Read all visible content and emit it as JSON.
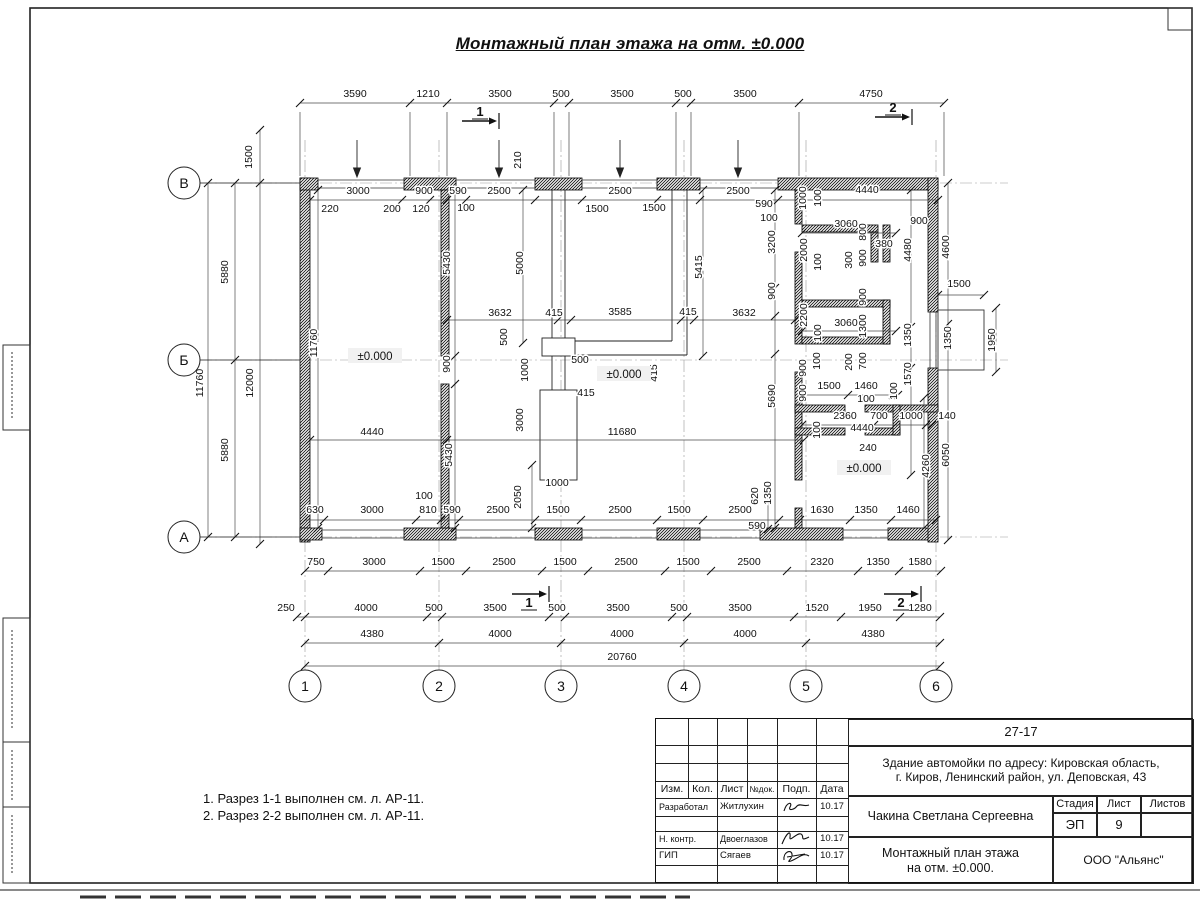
{
  "sheet": {
    "title": "Монтажный план этажа на отм. ±0.000",
    "notes": [
      "1. Разрез 1-1 выполнен см. л. АР-11.",
      "2. Разрез 2-2 выполнен см. л. АР-11."
    ]
  },
  "axes": {
    "row_labels": [
      "В",
      "Б",
      "А"
    ],
    "row_y": [
      183,
      360,
      537
    ],
    "col_labels": [
      "1",
      "2",
      "3",
      "4",
      "5",
      "6"
    ],
    "col_x": [
      305,
      439,
      561,
      684,
      806,
      936
    ]
  },
  "title_block": {
    "project_code": "27-17",
    "object_line1": "Здание автомойки по адресу: Кировская область,",
    "object_line2": "г. Киров, Ленинский район, ул. Деповская, 43",
    "client": "Чакина Светлана Сергеевна",
    "doc_title_line1": "Монтажный план этажа",
    "doc_title_line2": "на отм. ±0.000.",
    "organization": "ООО \"Альянс\"",
    "stage_label": "Стадия",
    "sheet_label": "Лист",
    "sheets_label": "Листов",
    "stage": "ЭП",
    "sheet_number": "9",
    "columns": [
      "Изм.",
      "Кол.",
      "Лист",
      "№док.",
      "Подп.",
      "Дата"
    ],
    "rows": [
      {
        "role": "Разработал",
        "name": "Житлухин",
        "date": "10.17"
      },
      {
        "role": "Н. контр.",
        "name": "Двоеглазов",
        "date": "10.17"
      },
      {
        "role": "ГИП",
        "name": "Сягаев",
        "date": "10.17"
      }
    ]
  },
  "drawing": {
    "dim_labels": [
      [
        "3590",
        355,
        97
      ],
      [
        "1210",
        428,
        97
      ],
      [
        "3500",
        500,
        97
      ],
      [
        "500",
        561,
        97
      ],
      [
        "3500",
        622,
        97
      ],
      [
        "500",
        683,
        97
      ],
      [
        "3500",
        745,
        97
      ],
      [
        "4750",
        871,
        97
      ],
      [
        "1500",
        252,
        157,
        1
      ],
      [
        "210",
        521,
        160,
        1
      ],
      [
        "3000",
        358,
        194
      ],
      [
        "900",
        424,
        194
      ],
      [
        "590",
        458,
        194
      ],
      [
        "2500",
        499,
        194
      ],
      [
        "2500",
        620,
        194
      ],
      [
        "2500",
        738,
        194
      ],
      [
        "4440",
        867,
        193
      ],
      [
        "220",
        330,
        212
      ],
      [
        "200",
        392,
        212
      ],
      [
        "120",
        421,
        212
      ],
      [
        "100",
        466,
        211
      ],
      [
        "1500",
        597,
        212
      ],
      [
        "1500",
        654,
        211
      ],
      [
        "590",
        764,
        207
      ],
      [
        "100",
        769,
        221
      ],
      [
        "1000",
        806,
        198,
        1
      ],
      [
        "100",
        821,
        198,
        1
      ],
      [
        "3060",
        846,
        227
      ],
      [
        "800",
        866,
        232,
        1
      ],
      [
        "900",
        919,
        224
      ],
      [
        "380",
        884,
        247
      ],
      [
        "2000",
        807,
        250,
        1
      ],
      [
        "100",
        821,
        262,
        1
      ],
      [
        "300",
        852,
        260,
        1
      ],
      [
        "900",
        866,
        258,
        1
      ],
      [
        "4480",
        911,
        250,
        1
      ],
      [
        "4600",
        949,
        247,
        1
      ],
      [
        "3200",
        775,
        242,
        1
      ],
      [
        "900",
        775,
        291,
        1
      ],
      [
        "5690",
        775,
        396,
        1
      ],
      [
        "5000",
        523,
        263,
        1
      ],
      [
        "5430",
        450,
        263,
        1
      ],
      [
        "5415",
        702,
        267,
        1
      ],
      [
        "11760",
        317,
        343,
        1
      ],
      [
        "5880",
        228,
        272,
        1
      ],
      [
        "11760",
        203,
        383,
        1
      ],
      [
        "12000",
        253,
        383,
        1
      ],
      [
        "5880",
        228,
        450,
        1
      ],
      [
        "3632",
        500,
        316
      ],
      [
        "415",
        554,
        316
      ],
      [
        "3585",
        620,
        315
      ],
      [
        "415",
        688,
        315
      ],
      [
        "3632",
        744,
        316
      ],
      [
        "500",
        507,
        337,
        1
      ],
      [
        "500",
        580,
        363
      ],
      [
        "900",
        450,
        364,
        1
      ],
      [
        "1000",
        528,
        370,
        1
      ],
      [
        "415",
        657,
        373,
        1
      ],
      [
        "415",
        586,
        396
      ],
      [
        "2200",
        807,
        315,
        1
      ],
      [
        "3060",
        846,
        326
      ],
      [
        "100",
        821,
        333,
        1
      ],
      [
        "900",
        866,
        297,
        1
      ],
      [
        "1300",
        866,
        326,
        1
      ],
      [
        "1350",
        911,
        335,
        1
      ],
      [
        "1500",
        959,
        287
      ],
      [
        "1350",
        951,
        338,
        1
      ],
      [
        "1950",
        995,
        340,
        1
      ],
      [
        "1570",
        911,
        374,
        1
      ],
      [
        "900",
        806,
        368,
        1
      ],
      [
        "100",
        820,
        361,
        1
      ],
      [
        "200",
        852,
        362,
        1
      ],
      [
        "700",
        866,
        361,
        1
      ],
      [
        "900",
        806,
        393,
        1
      ],
      [
        "1500",
        829,
        389
      ],
      [
        "1460",
        866,
        389
      ],
      [
        "100",
        897,
        391,
        1
      ],
      [
        "100",
        866,
        402
      ],
      [
        "2360",
        845,
        419
      ],
      [
        "700",
        879,
        419
      ],
      [
        "1000",
        911,
        419
      ],
      [
        "140",
        947,
        419
      ],
      [
        "100",
        820,
        430,
        1
      ],
      [
        "4440",
        862,
        431
      ],
      [
        "240",
        868,
        451
      ],
      [
        "4260",
        929,
        466,
        1
      ],
      [
        "6050",
        949,
        455,
        1
      ],
      [
        "3000",
        523,
        420,
        1
      ],
      [
        "4440",
        372,
        435
      ],
      [
        "11680",
        622,
        435
      ],
      [
        "5430",
        452,
        455,
        1
      ],
      [
        "1000",
        557,
        486
      ],
      [
        "2050",
        521,
        497,
        1
      ],
      [
        "620",
        758,
        496,
        1
      ],
      [
        "1350",
        771,
        493,
        1
      ],
      [
        "590",
        757,
        529
      ],
      [
        "630",
        315,
        513
      ],
      [
        "3000",
        372,
        513
      ],
      [
        "100",
        424,
        499
      ],
      [
        "810",
        428,
        513
      ],
      [
        "590",
        452,
        513
      ],
      [
        "2500",
        498,
        513
      ],
      [
        "1500",
        558,
        513
      ],
      [
        "2500",
        620,
        513
      ],
      [
        "1500",
        679,
        513
      ],
      [
        "2500",
        740,
        513
      ],
      [
        "1630",
        822,
        513
      ],
      [
        "1350",
        866,
        513
      ],
      [
        "1460",
        908,
        513
      ],
      [
        "750",
        316,
        565
      ],
      [
        "3000",
        374,
        565
      ],
      [
        "1500",
        443,
        565
      ],
      [
        "2500",
        504,
        565
      ],
      [
        "1500",
        565,
        565
      ],
      [
        "2500",
        626,
        565
      ],
      [
        "1500",
        688,
        565
      ],
      [
        "2500",
        749,
        565
      ],
      [
        "2320",
        822,
        565
      ],
      [
        "1350",
        878,
        565
      ],
      [
        "1580",
        920,
        565
      ],
      [
        "250",
        286,
        611
      ],
      [
        "4000",
        366,
        611
      ],
      [
        "500",
        434,
        611
      ],
      [
        "3500",
        495,
        611
      ],
      [
        "500",
        557,
        611
      ],
      [
        "3500",
        618,
        611
      ],
      [
        "500",
        679,
        611
      ],
      [
        "3500",
        740,
        611
      ],
      [
        "1520",
        817,
        611
      ],
      [
        "1950",
        870,
        611
      ],
      [
        "1280",
        920,
        611
      ],
      [
        "4380",
        372,
        637
      ],
      [
        "4000",
        500,
        637
      ],
      [
        "4000",
        622,
        637
      ],
      [
        "4000",
        745,
        637
      ],
      [
        "4380",
        873,
        637
      ],
      [
        "20760",
        622,
        660
      ]
    ],
    "dim_lines": [
      {
        "d": "h",
        "p": 103,
        "a": 300,
        "b": 944,
        "t": [
          300,
          410,
          447,
          554,
          569,
          676,
          691,
          799,
          944
        ]
      },
      {
        "d": "h",
        "p": 571,
        "a": 305,
        "b": 941,
        "t": [
          305,
          328,
          420,
          466,
          542,
          588,
          665,
          711,
          787,
          858,
          899,
          941
        ]
      },
      {
        "d": "h",
        "p": 617,
        "a": 297,
        "b": 940,
        "t": [
          297,
          305,
          427,
          442,
          549,
          565,
          672,
          687,
          794,
          841,
          900,
          940
        ]
      },
      {
        "d": "h",
        "p": 643,
        "a": 305,
        "b": 940,
        "t": [
          305,
          439,
          561,
          684,
          806,
          940
        ]
      },
      {
        "d": "h",
        "p": 666,
        "a": 305,
        "b": 940,
        "t": [
          305,
          940
        ]
      },
      {
        "d": "h",
        "p": 200,
        "a": 310,
        "b": 938,
        "t": [
          310,
          402,
          430,
          447,
          466,
          535,
          582,
          657,
          700,
          778,
          802,
          938
        ]
      },
      {
        "d": "h",
        "p": 320,
        "a": 447,
        "b": 795,
        "t": [
          447,
          558,
          571,
          681,
          694,
          795
        ]
      },
      {
        "d": "h",
        "p": 440,
        "a": 310,
        "b": 804,
        "t": [
          310,
          447,
          804
        ]
      },
      {
        "d": "h",
        "p": 520,
        "a": 305,
        "b": 936,
        "t": [
          305,
          324,
          416,
          441,
          459,
          535,
          581,
          657,
          703,
          779,
          800,
          850,
          891,
          936
        ]
      },
      {
        "d": "h",
        "p": 425,
        "a": 802,
        "b": 932,
        "t": [
          802,
          874,
          895,
          926,
          932
        ]
      },
      {
        "d": "h",
        "p": 395,
        "a": 802,
        "b": 898,
        "t": [
          802,
          848,
          893,
          898
        ]
      },
      {
        "d": "h",
        "p": 233,
        "a": 802,
        "b": 896,
        "t": [
          802,
          896
        ]
      },
      {
        "d": "h",
        "p": 331,
        "a": 802,
        "b": 896,
        "t": [
          802,
          896
        ]
      },
      {
        "d": "h",
        "p": 295,
        "a": 938,
        "b": 984,
        "t": [
          938,
          984
        ]
      },
      {
        "d": "v",
        "p": 208,
        "a": 183,
        "b": 537,
        "t": [
          183,
          537
        ]
      },
      {
        "d": "v",
        "p": 235,
        "a": 183,
        "b": 537,
        "t": [
          183,
          360,
          537
        ]
      },
      {
        "d": "v",
        "p": 260,
        "a": 130,
        "b": 544,
        "t": [
          130,
          183,
          544
        ]
      },
      {
        "d": "v",
        "p": 948,
        "a": 183,
        "b": 540,
        "t": [
          183,
          324,
          540
        ]
      },
      {
        "d": "v",
        "p": 996,
        "a": 308,
        "b": 372,
        "t": [
          308,
          372
        ]
      },
      {
        "d": "v",
        "p": 911,
        "a": 190,
        "b": 475,
        "t": [
          190,
          327,
          368,
          416,
          475
        ]
      },
      {
        "d": "v",
        "p": 703,
        "a": 190,
        "b": 356,
        "t": [
          190,
          356
        ]
      },
      {
        "d": "v",
        "p": 523,
        "a": 190,
        "b": 343,
        "t": [
          190,
          343
        ]
      },
      {
        "d": "v",
        "p": 775,
        "a": 190,
        "b": 528,
        "t": [
          190,
          288,
          316,
          354,
          528
        ]
      },
      {
        "d": "v",
        "p": 455,
        "a": 190,
        "b": 528,
        "t": [
          190,
          356,
          384,
          528
        ]
      },
      {
        "d": "v",
        "p": 318,
        "a": 190,
        "b": 528,
        "t": [
          190,
          528
        ]
      },
      {
        "d": "v",
        "p": 768,
        "a": 487,
        "b": 529,
        "t": [
          487,
          529
        ]
      },
      {
        "d": "v",
        "p": 924,
        "a": 398,
        "b": 528,
        "t": [
          398,
          528
        ]
      },
      {
        "d": "v",
        "p": 532,
        "a": 465,
        "b": 528,
        "t": [
          465,
          528
        ]
      }
    ],
    "level_marks": [
      {
        "t": "±0.000",
        "x": 375,
        "y": 358
      },
      {
        "t": "±0.000",
        "x": 624,
        "y": 376
      },
      {
        "t": "±0.000",
        "x": 864,
        "y": 470
      }
    ],
    "down_arrows": [
      357,
      499,
      620,
      738
    ],
    "section_marks": [
      {
        "n": "1",
        "tx": 480,
        "ty": 116,
        "x1": 462,
        "y1": 121,
        "x2": 497,
        "y2": 121
      },
      {
        "n": "2",
        "tx": 893,
        "ty": 112,
        "x1": 875,
        "y1": 117,
        "x2": 910,
        "y2": 117
      },
      {
        "n": "1",
        "tx": 529,
        "ty": 607,
        "x1": 512,
        "y1": 594,
        "x2": 547,
        "y2": 594
      },
      {
        "n": "2",
        "tx": 901,
        "ty": 607,
        "x1": 884,
        "y1": 594,
        "x2": 919,
        "y2": 594
      }
    ]
  }
}
